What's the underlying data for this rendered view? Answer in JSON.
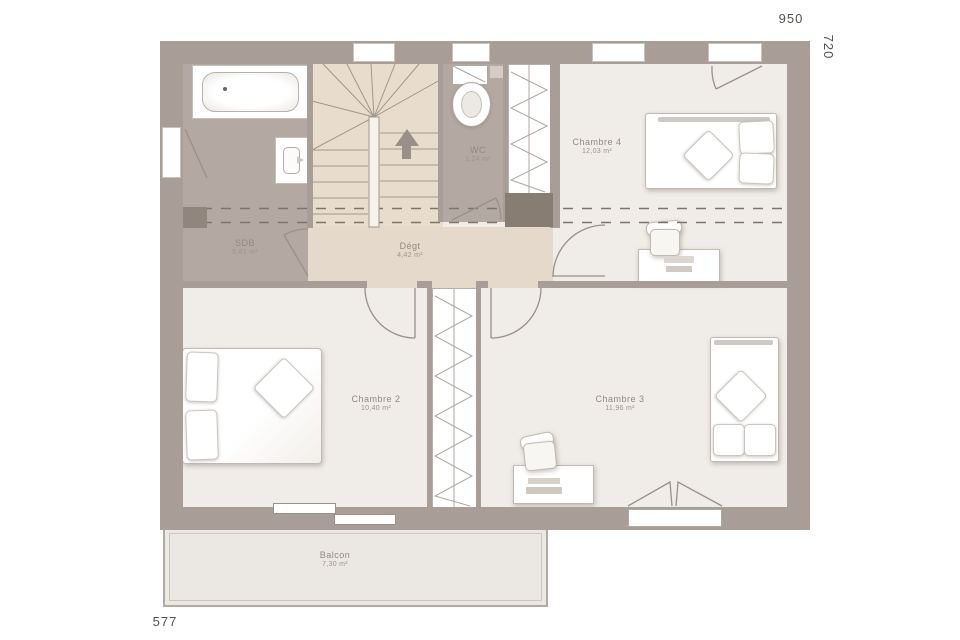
{
  "dimensions": {
    "top": "950",
    "right": "720",
    "bottom": "577"
  },
  "rooms": {
    "sdb": {
      "name": "SDB",
      "area": "5,81 m²"
    },
    "wc": {
      "name": "WC",
      "area": "1,24 m²"
    },
    "degt": {
      "name": "Dégt",
      "area": "4,42 m²"
    },
    "chambre4": {
      "name": "Chambre 4",
      "area": "12,03 m²"
    },
    "chambre2": {
      "name": "Chambre 2",
      "area": "10,40 m²"
    },
    "chambre3": {
      "name": "Chambre 3",
      "area": "11,96 m²"
    },
    "balcon": {
      "name": "Balcon",
      "area": "7,30 m²"
    }
  },
  "icons": {
    "stairs_direction": "up-arrow"
  },
  "colors": {
    "wall": "#a89e97",
    "wall-dark": "#887d73",
    "floor": "#f0ece7",
    "floor-wet": "#b3a9a2",
    "floor-stairs": "#e8dccd",
    "floor-landing": "#e5d9cb",
    "balcony": "#ebe8e3",
    "line": "#9b9088",
    "dash": "#7d746b",
    "label": "#938a80",
    "dim": "#55504a"
  }
}
